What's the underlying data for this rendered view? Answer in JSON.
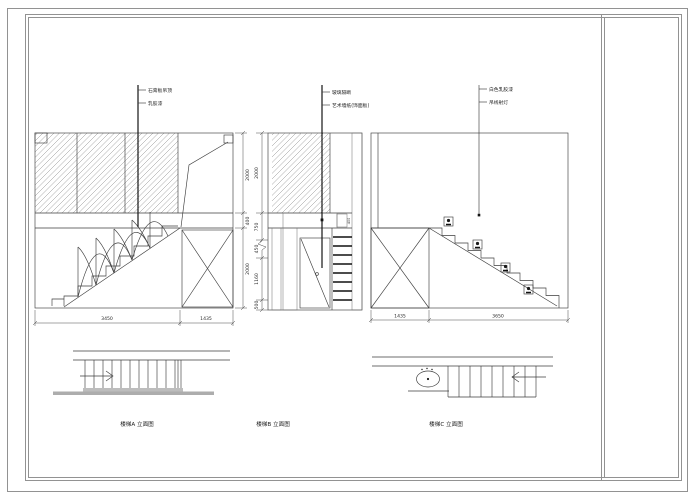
{
  "sheet": {
    "type_label": "staircase elevation CAD sheet",
    "colors": {
      "background": "#ffffff",
      "frame": "#929292",
      "line": "#3d3d3d",
      "dark_line": "#141414",
      "hatch": "#8f8f8f",
      "wall_bar_gray": "#adadad"
    }
  },
  "annotations": {
    "elev_a": {
      "labels": [
        "石膏板吊顶",
        "乳胶漆"
      ]
    },
    "elev_b": {
      "labels": [
        "玻璃隔断",
        "艺术墙纸(饰面板)"
      ]
    },
    "elev_c": {
      "labels": [
        "白色乳胶漆",
        "吊线射灯"
      ]
    }
  },
  "dimensions": {
    "elev_a_right": [
      "2000",
      "400",
      "2000"
    ],
    "elev_a_bottom": [
      "3450",
      "1435"
    ],
    "elev_b_left": [
      "2000",
      "750",
      "450",
      "1160",
      "500"
    ],
    "elev_b_inner": "400",
    "elev_c_bottom": [
      "1435",
      "3650"
    ]
  },
  "captions": [
    "楼梯A 立面图",
    "楼梯B 立面图",
    "楼梯C 立面图"
  ]
}
